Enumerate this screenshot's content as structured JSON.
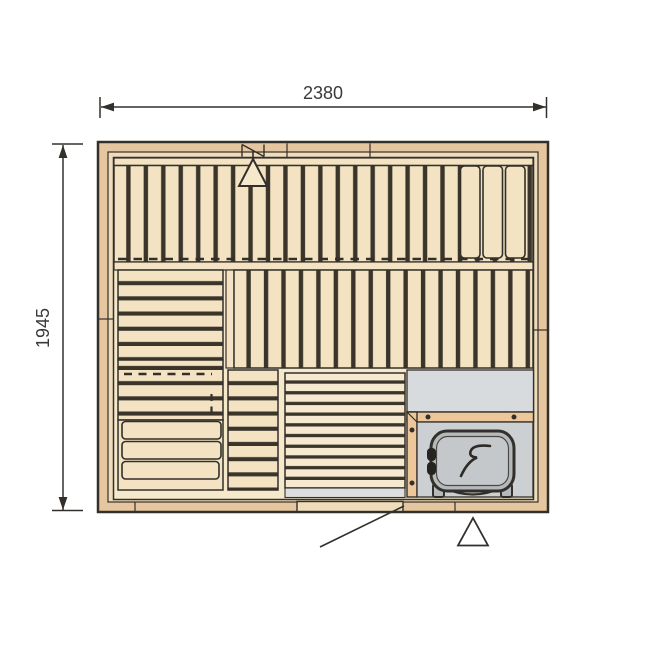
{
  "page": {
    "background": "#ffffff",
    "type": "sauna-floor-plan-drawing"
  },
  "dimensions": {
    "width_label": "2380",
    "height_label": "1945"
  },
  "colors": {
    "outline": "#33302b",
    "wall_wood": "#e5c69e",
    "wall_lining": "#efdcba",
    "bench_wood": "#f3e3c2",
    "interior": "#f6e9cb",
    "slat_gap": "#3a342b",
    "duck_board": "#f5e9cf",
    "floor_gray": "#d8dbde",
    "enclosure_gray": "#ccd0d3",
    "entrance_gray": "#dcdee0",
    "rail_wood": "#edc79a",
    "heater_body": "#b6b9bc",
    "heater_inner": "#c5c8cb",
    "dim_text": "#3a3a3a"
  },
  "symbols": {
    "heater_logo": "s-swoosh-logo",
    "top_vent": "triangle-vent",
    "bottom_vent": "triangle-vent",
    "wall_vent": "diagonal-vent-mark",
    "door_pointer": "leader-line"
  }
}
